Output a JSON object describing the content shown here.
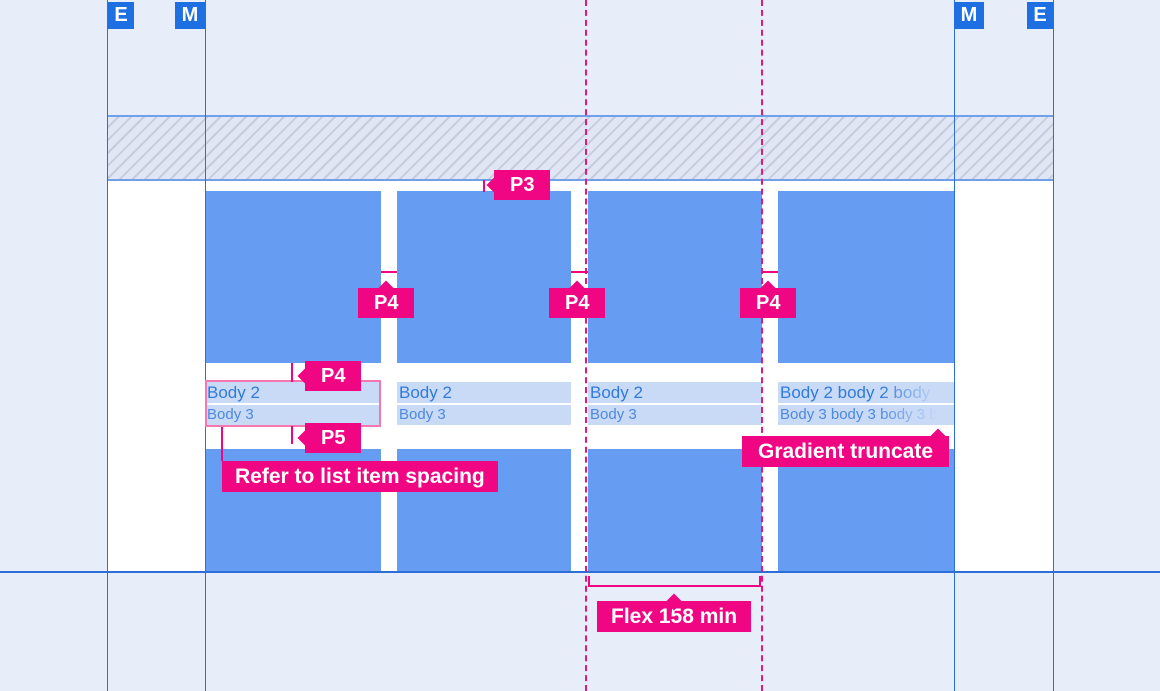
{
  "markers": {
    "left_outer": "E",
    "left_inner": "M",
    "right_inner": "M",
    "right_outer": "E"
  },
  "labels": {
    "p3": "P3",
    "p4": "P4",
    "p5": "P5",
    "refer": "Refer to list item spacing",
    "gradient": "Gradient truncate",
    "flex": "Flex 158 min"
  },
  "cards": [
    {
      "body2": "Body 2",
      "body3": "Body 3"
    },
    {
      "body2": "Body 2",
      "body3": "Body 3"
    },
    {
      "body2": "Body 2",
      "body3": "Body 3"
    },
    {
      "body2": "Body 2 body 2 body",
      "body3": "Body 3 body 3 body 3 b"
    }
  ],
  "colors": {
    "annotation_pink": "#F00582",
    "dashed_guide_pink": "#E2187D",
    "card_blue": "#679CF3",
    "marker_blue": "#1E70E2",
    "guide_line_blue": "#2B6FD9",
    "page_background": "#E8EEF9",
    "text_strip_background": "#C9DAF7",
    "body2_text": "#2F7BDB",
    "body3_text": "#4C89E0",
    "text_outline_pink": "#F477B0"
  }
}
